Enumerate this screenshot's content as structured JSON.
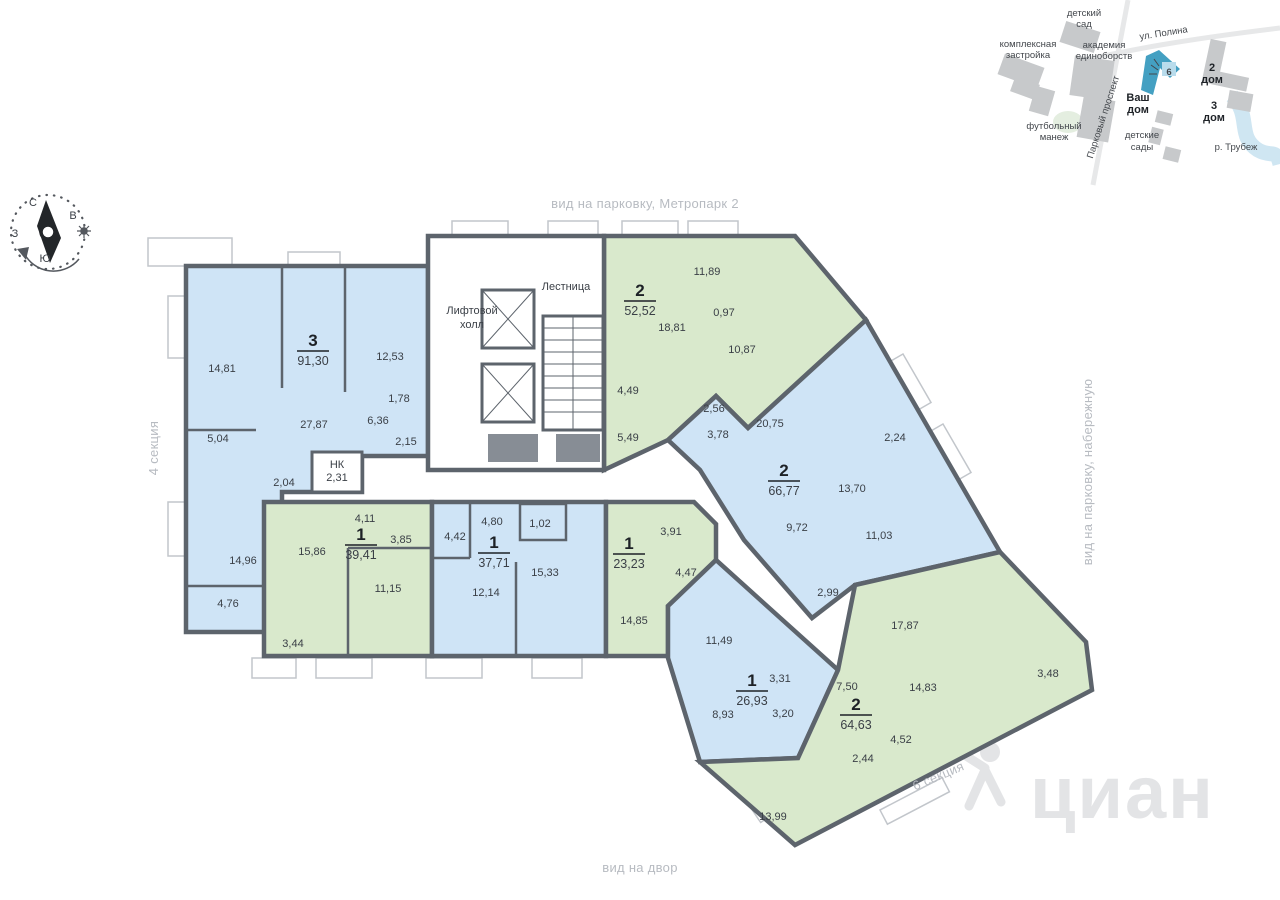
{
  "colors": {
    "apartment_blue": "#cfe4f6",
    "apartment_green": "#d9e9cc",
    "wall": "#5d646c",
    "muted_label": "#b7bbc1",
    "map_highlight_blue": "#44a0c2",
    "river_blue": "#cfe6f2",
    "watermark_gray": "#e3e4e6"
  },
  "labels": {
    "top_view": "вид на парковку, Метропарк 2",
    "bottom_view": "вид на двор",
    "section_left": "4 секция",
    "section_right": "6 секция",
    "right_view": "вид на парковку, набережную"
  },
  "compass": {
    "n": "С",
    "e": "В",
    "s": "Ю",
    "w": "З"
  },
  "core": {
    "lift_line1": "Лифтовой",
    "lift_line2": "холл",
    "stairs": "Лестница",
    "nk": "НК",
    "nk_area": "2,31"
  },
  "apartments": [
    {
      "type": "3",
      "area": "91,30",
      "color": "blue",
      "rooms": [
        "14,81",
        "12,53",
        "27,87",
        "6,36",
        "1,78",
        "2,15",
        "5,04",
        "2,04",
        "14,96",
        "4,76"
      ]
    },
    {
      "type": "2",
      "area": "52,52",
      "color": "green",
      "rooms": [
        "11,89",
        "0,97",
        "18,81",
        "10,87",
        "4,49",
        "5,49"
      ]
    },
    {
      "type": "2",
      "area": "66,77",
      "color": "blue",
      "rooms": [
        "2,56",
        "3,78",
        "20,75",
        "2,24",
        "13,70",
        "9,72",
        "11,03",
        "2,99"
      ]
    },
    {
      "type": "1",
      "area": "39,41",
      "color": "green",
      "rooms": [
        "15,86",
        "4,11",
        "3,85",
        "11,15",
        "3,44"
      ]
    },
    {
      "type": "1",
      "area": "37,71",
      "color": "blue",
      "rooms": [
        "4,42",
        "4,80",
        "1,02",
        "15,33",
        "12,14"
      ]
    },
    {
      "type": "1",
      "area": "23,23",
      "color": "green",
      "rooms": [
        "3,91",
        "4,47",
        "14,85"
      ]
    },
    {
      "type": "1",
      "area": "26,93",
      "color": "blue",
      "rooms": [
        "11,49",
        "3,31",
        "8,93",
        "3,20"
      ]
    },
    {
      "type": "2",
      "area": "64,63",
      "color": "green",
      "rooms": [
        "17,87",
        "7,50",
        "14,83",
        "4,52",
        "2,44",
        "13,99",
        "3,48"
      ]
    }
  ],
  "minimap": {
    "kindergarten_line1": "детский",
    "kindergarten_line2": "сад",
    "complex_line1": "комплексная",
    "complex_line2": "застройка",
    "academy_line1": "академия",
    "academy_line2": "единоборств",
    "street_polina": "ул. Полина",
    "street_parkovy": "Парковый проспект",
    "arena_line1": "футбольный",
    "arena_line2": "манеж",
    "your_house_line1": "Ваш",
    "your_house_line2": "дом",
    "house2_num": "2",
    "house2_word": "дом",
    "house3_num": "3",
    "house3_word": "дом",
    "kindergartens_line1": "детские",
    "kindergartens_line2": "сады",
    "river": "р. Трубеж",
    "building_mark": "6"
  },
  "watermark": "циан"
}
